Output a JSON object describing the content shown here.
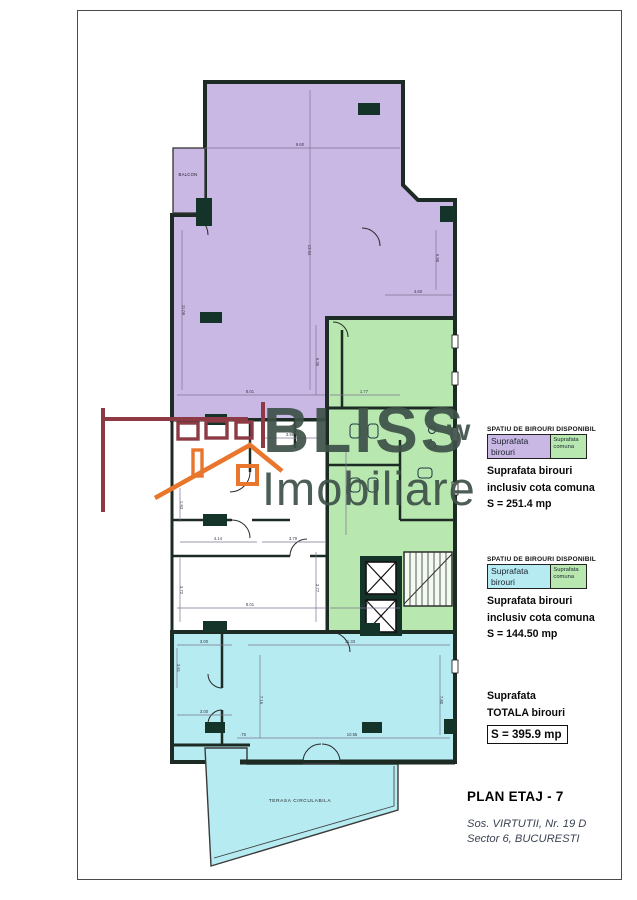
{
  "colors": {
    "office_purple": "#c9b7e4",
    "common_green": "#b8e8af",
    "office_cyan": "#b5ebf1",
    "wall_dark": "#1c2b23",
    "column_fill": "#143429",
    "dim_line": "#7f7493",
    "dim_text": "#3a3a4a",
    "watermark": "#3e5148",
    "logo_maroon": "#8d3a44",
    "logo_orange": "#e8762c",
    "frame_border": "#4a4a4a",
    "address_text": "#3c4454"
  },
  "watermark": {
    "line1": "BLISS",
    "line2": "Imobiliare",
    "mark": "w"
  },
  "floor_plan": {
    "balcony_label": "BALCON",
    "terrace_label": "TERASA CIRCULABILA",
    "dimension_labels": [
      {
        "t": "9.60",
        "x": 300,
        "y": 146,
        "r": 0
      },
      {
        "t": "13.64",
        "x": 308,
        "y": 250,
        "r": 90
      },
      {
        "t": "11.09",
        "x": 182,
        "y": 310,
        "r": 90
      },
      {
        "t": "5.90",
        "x": 436,
        "y": 258,
        "r": 90
      },
      {
        "t": "4.60",
        "x": 418,
        "y": 293,
        "r": 0
      },
      {
        "t": "5.36",
        "x": 316,
        "y": 362,
        "r": 90
      },
      {
        "t": "8.01",
        "x": 250,
        "y": 393,
        "r": 0
      },
      {
        "t": "1.77",
        "x": 364,
        "y": 393,
        "r": 0
      },
      {
        "t": "3.98",
        "x": 290,
        "y": 436,
        "r": 0
      },
      {
        "t": "4.10",
        "x": 346,
        "y": 490,
        "r": 90
      },
      {
        "t": "1.93",
        "x": 180,
        "y": 505,
        "r": 90
      },
      {
        "t": "4.14",
        "x": 218,
        "y": 540,
        "r": 0
      },
      {
        "t": "3.79",
        "x": 293,
        "y": 540,
        "r": 0
      },
      {
        "t": "3.72",
        "x": 180,
        "y": 590,
        "r": 90
      },
      {
        "t": "3.77",
        "x": 316,
        "y": 588,
        "r": 90
      },
      {
        "t": "8.01",
        "x": 250,
        "y": 606,
        "r": 0
      },
      {
        "t": "1.77",
        "x": 364,
        "y": 606,
        "r": 0
      },
      {
        "t": "3.00",
        "x": 204,
        "y": 643,
        "r": 0
      },
      {
        "t": "11.33",
        "x": 350,
        "y": 643,
        "r": 0
      },
      {
        "t": "3.61",
        "x": 177,
        "y": 668,
        "r": 90
      },
      {
        "t": "7.16",
        "x": 260,
        "y": 700,
        "r": 90
      },
      {
        "t": "7.80",
        "x": 440,
        "y": 700,
        "r": 90
      },
      {
        "t": "3.00",
        "x": 204,
        "y": 713,
        "r": 0
      },
      {
        "t": ".75",
        "x": 243,
        "y": 736,
        "r": 0
      },
      {
        "t": "10.55",
        "x": 352,
        "y": 736,
        "r": 0
      }
    ]
  },
  "info_panel": {
    "block1": {
      "header": "SPATIU DE BIROURI DISPONIBIL",
      "legend_left": "Suprafata birouri",
      "legend_right": "Suprafata comuna",
      "line1": "Suprafata birouri",
      "line2": "inclusiv cota comuna",
      "area": "S = 251.4 mp"
    },
    "block2": {
      "header": "SPATIU DE BIROURI DISPONIBIL",
      "legend_left": "Suprafata birouri",
      "legend_right": "Suprafata comuna",
      "line1": "Suprafata birouri",
      "line2": "inclusiv cota comuna",
      "area": "S = 144.50 mp"
    },
    "total": {
      "line1": "Suprafata",
      "line2": "TOTALA birouri",
      "area": "S = 395.9 mp"
    },
    "plan_title": "PLAN ETAJ - 7",
    "address_line1": "Sos. VIRTUTII, Nr. 19 D",
    "address_line2": "Sector 6, BUCURESTI"
  }
}
